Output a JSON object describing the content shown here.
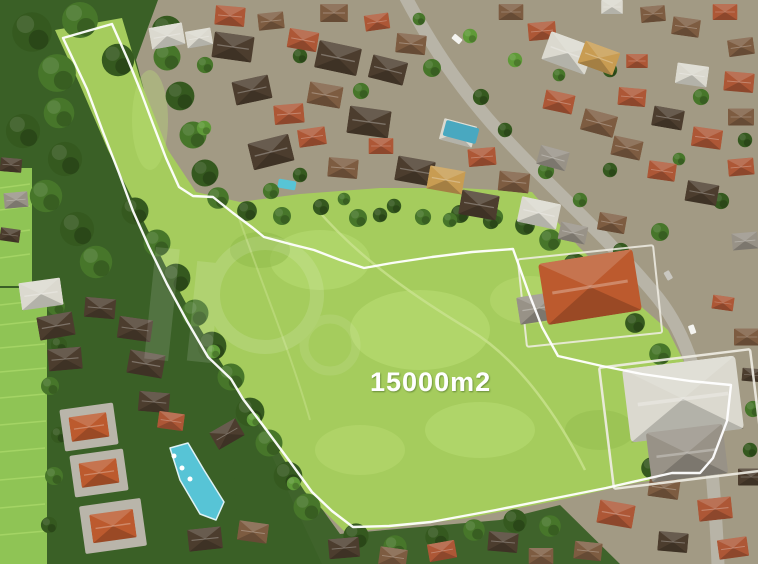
{
  "scene": {
    "type": "aerial-drone-photo-of-land-plot",
    "area_label": "15000m2",
    "watermark": {
      "visible": true,
      "style": "faint translucent circular logo"
    }
  },
  "palette": {
    "village_base": "#a29a84",
    "jungle": "#3a6026",
    "tree_dark": "#35591f",
    "tree_mid": "#47762a",
    "tree_light": "#5f9a38",
    "meadow": "#a5cc5d",
    "meadow_light": "#bddf78",
    "field": "#8fc455",
    "field_light": "#aad869",
    "road": "#b8b4a7",
    "roof_terracotta": "#ad5736",
    "roof_terracotta_bright": "#bc5a2e",
    "roof_brown": "#7d5c41",
    "roof_dark": "#4c3d2e",
    "roof_grey": "#989287",
    "roof_white": "#dbd9cf",
    "roof_yellow": "#c89c52",
    "pool": "#57c4d6",
    "wall": "#f0ede4",
    "boundary": "#ffffff",
    "label": "#ffffff"
  }
}
